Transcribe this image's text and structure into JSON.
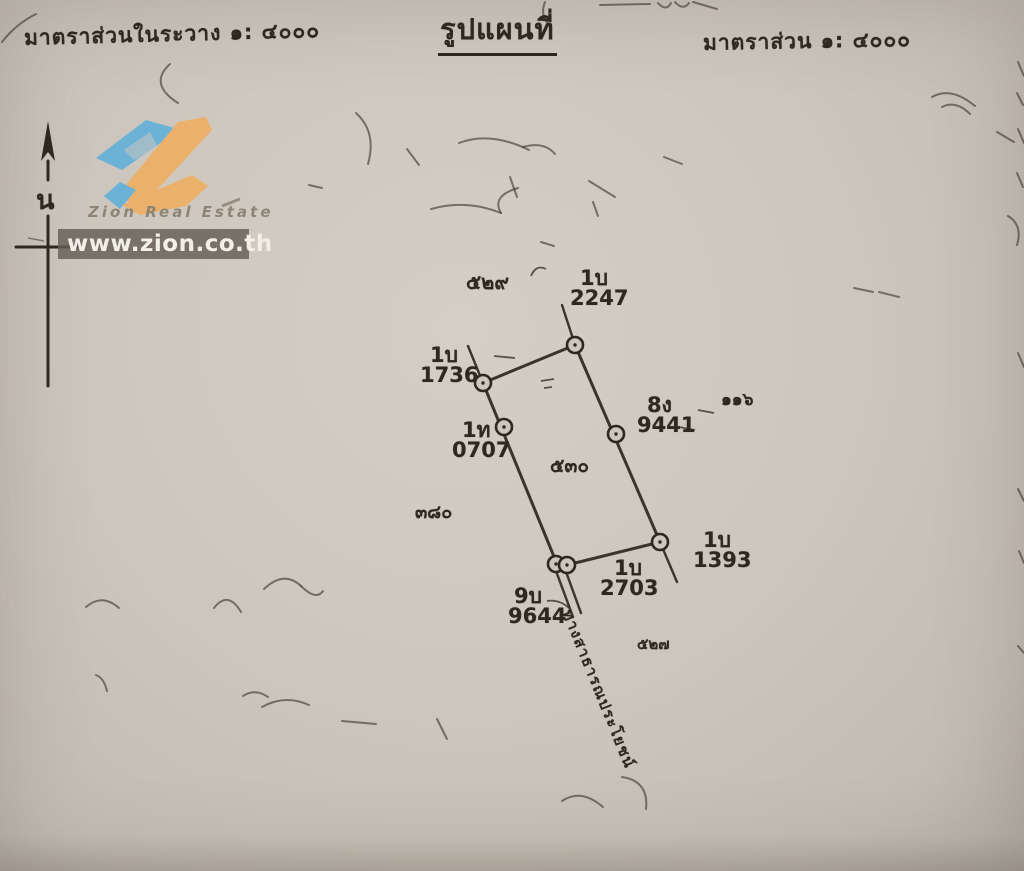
{
  "header": {
    "scale_left": "มาตราส่วนในระวาง  ๑: ๔๐๐๐",
    "title": "รูปแผนที่",
    "scale_right": "มาตราส่วน  ๑: ๔๐๐๐"
  },
  "watermark": {
    "brand": "Zion Real Estate",
    "url": "www.zion.co.th"
  },
  "compass": {
    "north_label": "น"
  },
  "map": {
    "parcel_number": "๕๓๐",
    "adjacent_numbers": {
      "top": "๕๒๙",
      "right": "๑๑๖",
      "left": "๓๘๐",
      "bottom": "๕๒๗"
    },
    "markers": [
      {
        "prefix": "1บ",
        "number": "2247"
      },
      {
        "prefix": "1บ",
        "number": "1736"
      },
      {
        "prefix": "1ท",
        "number": "0707"
      },
      {
        "prefix": "8ง",
        "number": "9441"
      },
      {
        "prefix": "1บ",
        "number": "1393"
      },
      {
        "prefix": "1บ",
        "number": "2703"
      },
      {
        "prefix": "9บ",
        "number": "9644"
      }
    ],
    "road_label": "ทางสาธารณประโยชน์"
  },
  "colors": {
    "paper": "#cdc6bd",
    "ink": "#2e2821",
    "logo_blue": "#57aedd",
    "logo_orange": "#f2ab57",
    "bar_gray": "#645e55"
  }
}
